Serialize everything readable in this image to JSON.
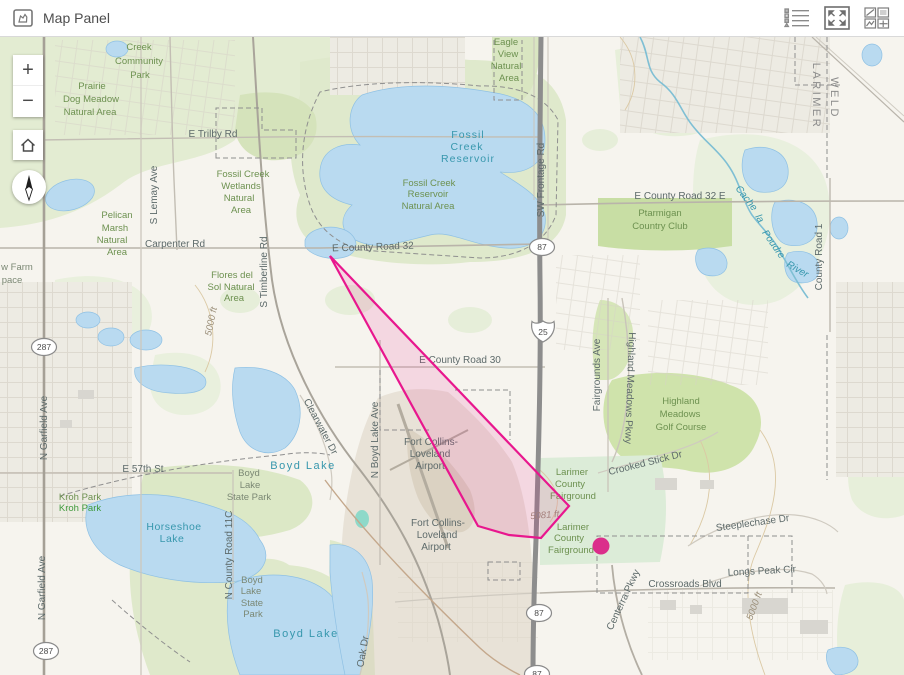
{
  "header": {
    "title": "Map Panel",
    "icons": [
      {
        "name": "map-panel-icon"
      },
      {
        "name": "legend-list-icon"
      },
      {
        "name": "expand-icon"
      },
      {
        "name": "widget-gallery-icon"
      }
    ]
  },
  "controls": {
    "zoom_in_label": "+",
    "zoom_out_label": "−",
    "home_icon": "home-icon",
    "compass_icon": "compass-needle-icon"
  },
  "map": {
    "labels": {
      "green": [
        {
          "t": "Creek",
          "x": 139,
          "y": 50
        },
        {
          "t": "Community",
          "x": 139,
          "y": 64
        },
        {
          "t": "Park",
          "x": 140,
          "y": 78
        },
        {
          "t": "Prairie",
          "x": 92,
          "y": 89
        },
        {
          "t": "Dog Meadow",
          "x": 91,
          "y": 102
        },
        {
          "t": "Natural Area",
          "x": 90,
          "y": 115
        },
        {
          "t": "Fossil Creek",
          "x": 243,
          "y": 177
        },
        {
          "t": "Wetlands",
          "x": 241,
          "y": 189
        },
        {
          "t": "Natural",
          "x": 239,
          "y": 201
        },
        {
          "t": "Area",
          "x": 241,
          "y": 213
        },
        {
          "t": "Pelican",
          "x": 117,
          "y": 218
        },
        {
          "t": "Marsh",
          "x": 115,
          "y": 231
        },
        {
          "t": "Natural",
          "x": 112,
          "y": 243
        },
        {
          "t": "Area",
          "x": 117,
          "y": 255
        },
        {
          "t": "Eagle",
          "x": 506,
          "y": 45
        },
        {
          "t": "View",
          "x": 508,
          "y": 57
        },
        {
          "t": "Natural",
          "x": 506,
          "y": 69
        },
        {
          "t": "Area",
          "x": 509,
          "y": 81
        },
        {
          "t": "Fossil Creek",
          "x": 429,
          "y": 186
        },
        {
          "t": "Reservoir",
          "x": 428,
          "y": 197
        },
        {
          "t": "Natural Area",
          "x": 428,
          "y": 209
        },
        {
          "t": "Flores del",
          "x": 232,
          "y": 278
        },
        {
          "t": "Sol Natural",
          "x": 231,
          "y": 290
        },
        {
          "t": "Area",
          "x": 234,
          "y": 301
        },
        {
          "t": "Ptarmigan",
          "x": 660,
          "y": 216
        },
        {
          "t": "Country Club",
          "x": 660,
          "y": 229
        },
        {
          "t": "Highland",
          "x": 681,
          "y": 404
        },
        {
          "t": "Meadows",
          "x": 680,
          "y": 417
        },
        {
          "t": "Golf Course",
          "x": 681,
          "y": 430
        },
        {
          "t": "Larimer",
          "x": 572,
          "y": 475
        },
        {
          "t": "County",
          "x": 570,
          "y": 487
        },
        {
          "t": "Fairground",
          "x": 573,
          "y": 499
        },
        {
          "t": "Larimer",
          "x": 573,
          "y": 530
        },
        {
          "t": "County",
          "x": 569,
          "y": 541
        },
        {
          "t": "Fairground",
          "x": 571,
          "y": 553
        },
        {
          "t": "Kroh Park",
          "x": 80,
          "y": 500
        }
      ],
      "green_bright": [
        {
          "t": "Kroh Park",
          "x": 80,
          "y": 511
        }
      ],
      "graygreen": [
        {
          "t": "Boyd",
          "x": 249,
          "y": 476
        },
        {
          "t": "Lake",
          "x": 250,
          "y": 488
        },
        {
          "t": "State Park",
          "x": 249,
          "y": 500
        },
        {
          "t": "Boyd",
          "x": 252,
          "y": 583
        },
        {
          "t": "Lake",
          "x": 251,
          "y": 594
        },
        {
          "t": "State",
          "x": 252,
          "y": 606
        },
        {
          "t": "Park",
          "x": 253,
          "y": 617
        },
        {
          "t": "w Farm",
          "x": 17,
          "y": 270
        },
        {
          "t": "pace",
          "x": 12,
          "y": 283
        }
      ],
      "water": [
        {
          "t": "Fossil",
          "x": 468,
          "y": 138,
          "s": 10.5,
          "ls": 1
        },
        {
          "t": "Creek",
          "x": 467,
          "y": 150,
          "s": 10.5,
          "ls": 1
        },
        {
          "t": "Reservoir",
          "x": 468,
          "y": 162,
          "s": 10.5,
          "ls": 1
        },
        {
          "t": "Boyd Lake",
          "x": 303,
          "y": 469,
          "s": 11,
          "ls": 1.5
        },
        {
          "t": "Boyd Lake",
          "x": 306,
          "y": 637,
          "s": 11,
          "ls": 1.5
        },
        {
          "t": "Horseshoe",
          "x": 174,
          "y": 530,
          "s": 10.5,
          "ls": 0.5
        },
        {
          "t": "Lake",
          "x": 172,
          "y": 542,
          "s": 10.5,
          "ls": 0.5
        },
        {
          "t": "Cache",
          "x": 744,
          "y": 200,
          "r": 52,
          "i": 1
        },
        {
          "t": "la",
          "x": 757,
          "y": 220,
          "r": 60,
          "i": 1
        },
        {
          "t": "Poudre",
          "x": 771,
          "y": 246,
          "r": 55,
          "i": 1
        },
        {
          "t": "River",
          "x": 796,
          "y": 272,
          "r": 30,
          "i": 1
        }
      ],
      "roads": [
        {
          "t": "E Trilby Rd",
          "x": 213,
          "y": 137
        },
        {
          "t": "Carpenter Rd",
          "x": 175,
          "y": 247
        },
        {
          "t": "E County Road 32",
          "x": 373,
          "y": 250,
          "r": -2
        },
        {
          "t": "E County Road 32 E",
          "x": 680,
          "y": 199
        },
        {
          "t": "E County Road 30",
          "x": 460,
          "y": 363
        },
        {
          "t": "E 57th St",
          "x": 143,
          "y": 472
        },
        {
          "t": "Crossroads Blvd",
          "x": 685,
          "y": 587
        },
        {
          "t": "Steeplechase Dr",
          "x": 753,
          "y": 526,
          "r": -8
        },
        {
          "t": "Longs Peak Cir",
          "x": 762,
          "y": 574,
          "r": -3
        },
        {
          "t": "Crooked Stick Dr",
          "x": 646,
          "y": 466,
          "r": -14
        },
        {
          "t": "S Lemay Ave",
          "x": 157,
          "y": 195,
          "r": -90
        },
        {
          "t": "S Timberline Rd",
          "x": 267,
          "y": 272,
          "r": -90
        },
        {
          "t": "N Garfield Ave",
          "x": 47,
          "y": 428,
          "r": -90
        },
        {
          "t": "N Garfield Ave",
          "x": 45,
          "y": 588,
          "r": -90
        },
        {
          "t": "N Boyd Lake Ave",
          "x": 378,
          "y": 440,
          "r": -90
        },
        {
          "t": "N County Road 11C",
          "x": 232,
          "y": 555,
          "r": -90
        },
        {
          "t": "SW Frontage Rd",
          "x": 544,
          "y": 180,
          "r": -90
        },
        {
          "t": "Fairgrounds Ave",
          "x": 600,
          "y": 375,
          "r": -90
        },
        {
          "t": "Highland Meadows Pkwy",
          "x": 627,
          "y": 388,
          "r": 92
        },
        {
          "t": "Centerra Pkwy",
          "x": 626,
          "y": 601,
          "r": -65
        },
        {
          "t": "Clearwater Dr",
          "x": 318,
          "y": 428,
          "r": 62
        },
        {
          "t": "County Road 1",
          "x": 822,
          "y": 257,
          "r": -90
        },
        {
          "t": "Oak Dr",
          "x": 366,
          "y": 652,
          "r": -80
        },
        {
          "t": "Fort Collins-",
          "x": 431,
          "y": 445
        },
        {
          "t": "Loveland",
          "x": 430,
          "y": 457
        },
        {
          "t": "Airport",
          "x": 430,
          "y": 469
        },
        {
          "t": "Fort Collins-",
          "x": 438,
          "y": 526
        },
        {
          "t": "Loveland",
          "x": 437,
          "y": 538
        },
        {
          "t": "Airport",
          "x": 436,
          "y": 550
        }
      ],
      "county": [
        {
          "t": "LARIMER",
          "x": 813,
          "y": 96,
          "r": 90
        },
        {
          "t": "WELD",
          "x": 831,
          "y": 98,
          "r": 90
        }
      ],
      "elevation": [
        {
          "t": "5081 ft",
          "x": 545,
          "y": 518,
          "r": -5
        },
        {
          "t": "5000 ft",
          "x": 214,
          "y": 322,
          "r": -78
        },
        {
          "t": "5000 ft",
          "x": 757,
          "y": 607,
          "r": -70
        }
      ]
    },
    "shields": {
      "us": [
        {
          "t": "287",
          "x": 44,
          "y": 347
        },
        {
          "t": "287",
          "x": 46,
          "y": 651
        },
        {
          "t": "87",
          "x": 542,
          "y": 247
        },
        {
          "t": "87",
          "x": 539,
          "y": 613
        },
        {
          "t": "87",
          "x": 537,
          "y": 674
        }
      ],
      "interstate": [
        {
          "t": "25",
          "x": 543,
          "y": 331
        }
      ]
    },
    "annotation": {
      "polygon_points": "330,256 478,526 509,535 541,538 569,506",
      "polygon_color": "#e8178e",
      "polygon_fill": "rgba(232,23,142,0.13)",
      "point": {
        "cx": 601,
        "cy": 546,
        "r": 8.5,
        "color": "#db2e8b"
      }
    }
  }
}
